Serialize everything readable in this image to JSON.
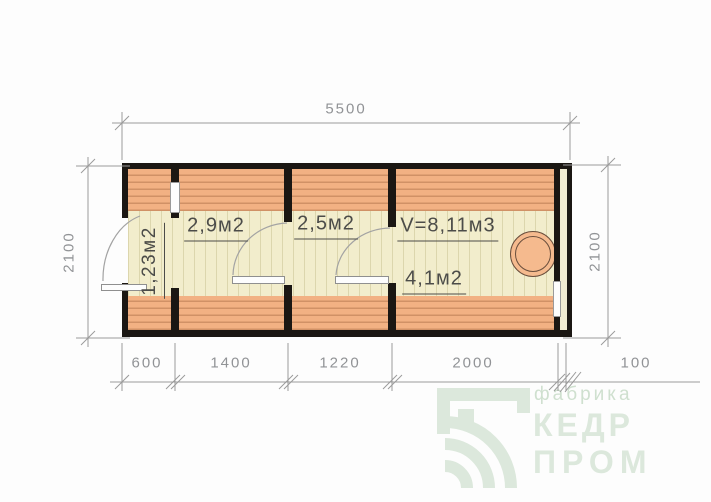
{
  "rooms": [
    {
      "area_label": "1,23м2"
    },
    {
      "area_label": "2,9м2"
    },
    {
      "area_label": "2,5м2"
    },
    {
      "volume_label": "V=8,11м3",
      "area_label": "4,1м2"
    }
  ],
  "dimensions": {
    "total_length": "5500",
    "depth_left": "2100",
    "depth_right": "2100",
    "bottom_segments": [
      "600",
      "1400",
      "1220",
      "2000",
      "100"
    ]
  },
  "watermark": {
    "tagline": "фабрика",
    "brand_line1": "КЕДР",
    "brand_line2": "ПРОМ"
  },
  "colors": {
    "wall_black": "#1b1713",
    "plank_orange": "#f2b183",
    "plank_line": "#d09166",
    "floor_cream": "#f2edcc",
    "floor_line": "#dcd6ad",
    "stove_fill": "#f5ba8e",
    "stove_stroke": "#6a4e3c",
    "dimension_gray": "#919396",
    "label_dark": "#4c4c49",
    "watermark_green": "#dce8dc"
  }
}
